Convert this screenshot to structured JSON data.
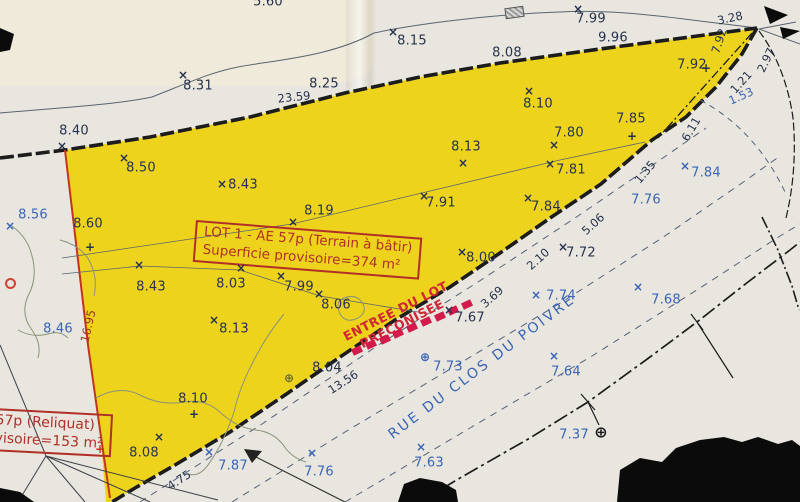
{
  "colors": {
    "paper": "#e8e6de",
    "paper_light": "#f0ead9",
    "yellow": "#eed31c",
    "ink": "#1c1c1c",
    "thin": "#5a6470",
    "navy": "#26324f",
    "blue": "#3a64b8",
    "red": "#c23320",
    "darkred": "#b03028",
    "magenta": "#d41a4a",
    "maroon": "#9c3220",
    "olive": "#6b6b1f",
    "contour": "#8a9478",
    "roadline": "#55627a"
  },
  "lot_box": {
    "line1": "LOT 1 - AE 57p (Terrain à bâtir)",
    "line2": "Superficie provisoire=374 m²"
  },
  "reliquat_box": {
    "line1": "57p (Reliquat)",
    "line2": "visoire=153 m²"
  },
  "entrance": {
    "line1": "ENTREE DU LOT",
    "line2": "PRECONISEE",
    "hatch": {
      "x1": 352,
      "y1": 347,
      "x2": 462,
      "y2": 301,
      "count": 9
    }
  },
  "street": {
    "name": "RUE DU CLOS DU POIVRE"
  },
  "top_partial": {
    "value": "5.60"
  },
  "points": [
    {
      "v": "8.40",
      "x": 74,
      "y": 131,
      "c": "navy",
      "m": "×",
      "mx": 62,
      "my": 146
    },
    {
      "v": "8.31",
      "x": 198,
      "y": 86,
      "c": "navy",
      "m": "×",
      "mx": 183,
      "my": 75
    },
    {
      "v": "8.25",
      "x": 324,
      "y": 84,
      "c": "navy"
    },
    {
      "v": "8.15",
      "x": 412,
      "y": 41,
      "c": "navy",
      "m": "×",
      "mx": 393,
      "my": 32
    },
    {
      "v": "7.99",
      "x": 591,
      "y": 19,
      "c": "navy",
      "m": "×",
      "mx": 578,
      "my": 9
    },
    {
      "v": "9.96",
      "x": 613,
      "y": 38,
      "c": "navy"
    },
    {
      "v": "8.08",
      "x": 507,
      "y": 53,
      "c": "navy"
    },
    {
      "v": "7.92",
      "x": 692,
      "y": 65,
      "c": "navy",
      "m": "+",
      "mx": 706,
      "my": 68
    },
    {
      "v": "8.10",
      "x": 538,
      "y": 104,
      "c": "navy",
      "m": "×",
      "mx": 529,
      "my": 91
    },
    {
      "v": "7.85",
      "x": 631,
      "y": 119,
      "c": "navy",
      "m": "+",
      "mx": 632,
      "my": 136
    },
    {
      "v": "7.80",
      "x": 569,
      "y": 133,
      "c": "navy",
      "m": "×",
      "mx": 554,
      "my": 145
    },
    {
      "v": "8.13",
      "x": 466,
      "y": 147,
      "c": "navy",
      "m": "×",
      "mx": 463,
      "my": 163
    },
    {
      "v": "7.81",
      "x": 571,
      "y": 170,
      "c": "navy",
      "m": "×",
      "mx": 550,
      "my": 164
    },
    {
      "v": "8.50",
      "x": 141,
      "y": 168,
      "c": "navy",
      "m": "×",
      "mx": 124,
      "my": 158
    },
    {
      "v": "8.43",
      "x": 243,
      "y": 185,
      "c": "navy",
      "m": "×",
      "mx": 222,
      "my": 184
    },
    {
      "v": "7.91",
      "x": 441,
      "y": 203,
      "c": "navy",
      "m": "×",
      "mx": 424,
      "my": 196
    },
    {
      "v": "7.84",
      "x": 546,
      "y": 207,
      "c": "navy",
      "m": "×",
      "mx": 528,
      "my": 198
    },
    {
      "v": "8.19",
      "x": 319,
      "y": 211,
      "c": "navy",
      "m": "×",
      "mx": 293,
      "my": 222
    },
    {
      "v": "8.56",
      "x": 33,
      "y": 215,
      "c": "blue",
      "m": "×",
      "mx": 10,
      "my": 226
    },
    {
      "v": "8.60",
      "x": 88,
      "y": 224,
      "c": "navy",
      "m": "+",
      "mx": 90,
      "my": 247
    },
    {
      "v": "7.84",
      "x": 706,
      "y": 173,
      "c": "blue",
      "m": "×",
      "mx": 685,
      "my": 166
    },
    {
      "v": "7.76",
      "x": 646,
      "y": 200,
      "c": "blue"
    },
    {
      "v": "8.00",
      "x": 481,
      "y": 258,
      "c": "navy",
      "m": "×",
      "mx": 462,
      "my": 252
    },
    {
      "v": "7.72",
      "x": 581,
      "y": 253,
      "c": "navy",
      "m": "×",
      "mx": 563,
      "my": 247
    },
    {
      "v": "8.43",
      "x": 151,
      "y": 287,
      "c": "navy",
      "m": "×",
      "mx": 139,
      "my": 265
    },
    {
      "v": "8.03",
      "x": 231,
      "y": 284,
      "c": "navy",
      "m": "×",
      "mx": 241,
      "my": 268
    },
    {
      "v": "7.99",
      "x": 299,
      "y": 287,
      "c": "navy",
      "m": "×",
      "mx": 281,
      "my": 276
    },
    {
      "v": "8.06",
      "x": 336,
      "y": 305,
      "c": "navy",
      "m": "×",
      "mx": 319,
      "my": 294
    },
    {
      "v": "8.46",
      "x": 58,
      "y": 329,
      "c": "blue"
    },
    {
      "v": "7.67",
      "x": 470,
      "y": 318,
      "c": "navy",
      "m": "×",
      "mx": 449,
      "my": 310
    },
    {
      "v": "7.74",
      "x": 561,
      "y": 296,
      "c": "blue",
      "m": "×",
      "mx": 536,
      "my": 295
    },
    {
      "v": "7.68",
      "x": 666,
      "y": 300,
      "c": "blue",
      "m": "×",
      "mx": 638,
      "my": 287
    },
    {
      "v": "7.73",
      "x": 448,
      "y": 367,
      "c": "blue",
      "m": "⊕",
      "mx": 425,
      "my": 357
    },
    {
      "v": "8.13",
      "x": 234,
      "y": 329,
      "c": "navy",
      "m": "×",
      "mx": 214,
      "my": 320
    },
    {
      "v": "8.04",
      "x": 327,
      "y": 368,
      "c": "navy",
      "m": "⊕",
      "mx": 289,
      "my": 378,
      "mc": "olive"
    },
    {
      "v": "8.10",
      "x": 193,
      "y": 399,
      "c": "navy",
      "m": "+",
      "mx": 194,
      "my": 414
    },
    {
      "v": "8.08",
      "x": 144,
      "y": 453,
      "c": "navy",
      "m": "×",
      "mx": 159,
      "my": 437
    },
    {
      "v": "7.87",
      "x": 233,
      "y": 466,
      "c": "blue",
      "m": "×",
      "mx": 209,
      "my": 452
    },
    {
      "v": "7.76",
      "x": 319,
      "y": 472,
      "c": "blue",
      "m": "×",
      "mx": 312,
      "my": 453
    },
    {
      "v": "7.64",
      "x": 566,
      "y": 372,
      "c": "blue",
      "m": "×",
      "mx": 554,
      "my": 356
    },
    {
      "v": "7.63",
      "x": 429,
      "y": 463,
      "c": "blue",
      "m": "×",
      "mx": 421,
      "my": 447
    },
    {
      "v": "7.37",
      "x": 574,
      "y": 435,
      "c": "blue",
      "m": "⊕",
      "mx": 601,
      "my": 432,
      "mc": "ink",
      "ms": 16
    }
  ],
  "dims": [
    {
      "v": "23.59",
      "x": 294,
      "y": 97,
      "r": -6
    },
    {
      "v": "3.28",
      "x": 730,
      "y": 18,
      "r": -12
    },
    {
      "v": "7.92",
      "x": 719,
      "y": 41,
      "r": -72
    },
    {
      "v": "2.97",
      "x": 766,
      "y": 60,
      "r": -64
    },
    {
      "v": "1.21",
      "x": 741,
      "y": 82,
      "r": -48
    },
    {
      "v": "1.53",
      "x": 741,
      "y": 96,
      "r": -24,
      "c": "blue"
    },
    {
      "v": "6.11",
      "x": 691,
      "y": 129,
      "r": -60
    },
    {
      "v": "1.35",
      "x": 645,
      "y": 172,
      "r": -50
    },
    {
      "v": "5.06",
      "x": 593,
      "y": 224,
      "r": -42
    },
    {
      "v": "2.10",
      "x": 538,
      "y": 259,
      "r": -42
    },
    {
      "v": "3.69",
      "x": 492,
      "y": 297,
      "r": -42
    },
    {
      "v": "13.56",
      "x": 343,
      "y": 382,
      "r": -33
    },
    {
      "v": "4.75",
      "x": 179,
      "y": 480,
      "r": -33
    },
    {
      "v": "16.95",
      "x": 88,
      "y": 326,
      "r": -77,
      "c": "maroon"
    }
  ]
}
